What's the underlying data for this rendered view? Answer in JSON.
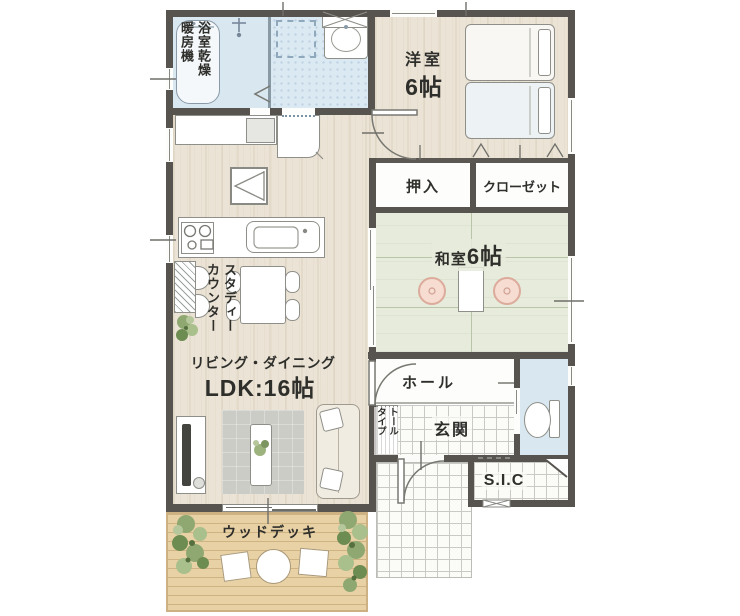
{
  "floorplan": {
    "bathroom": {
      "heater_label_col1": "浴室乾燥",
      "heater_label_col2": "暖房機"
    },
    "western_room": {
      "name": "洋室",
      "size": "6帖"
    },
    "storage": {
      "oshiire": "押入",
      "closet": "クローゼット"
    },
    "japanese_room": {
      "name": "和室",
      "size": "6帖"
    },
    "ldk": {
      "study_counter_col1": "スタディー",
      "study_counter_col2": "カウンター",
      "living_dining": "リビング・ダイニング",
      "size": "LDK:16帖"
    },
    "entrance_area": {
      "hall": "ホール",
      "entrance": "玄関",
      "shoe_cabinet_col1": "トール",
      "shoe_cabinet_col2": "タイプ",
      "sic": "S.I.C"
    },
    "outdoor": {
      "wood_deck": "ウッドデッキ"
    },
    "colors": {
      "wall": "#575450",
      "wood_floor": "#ebe3d5",
      "tatami_green": "#e6ebdb",
      "wet_area_blue": "#dbe9f3",
      "deck_tan": "#e8d1a5",
      "cushion_pink": "#f6dcd1",
      "plant_green": "#8fa871",
      "text": "#2e2e2b"
    }
  }
}
